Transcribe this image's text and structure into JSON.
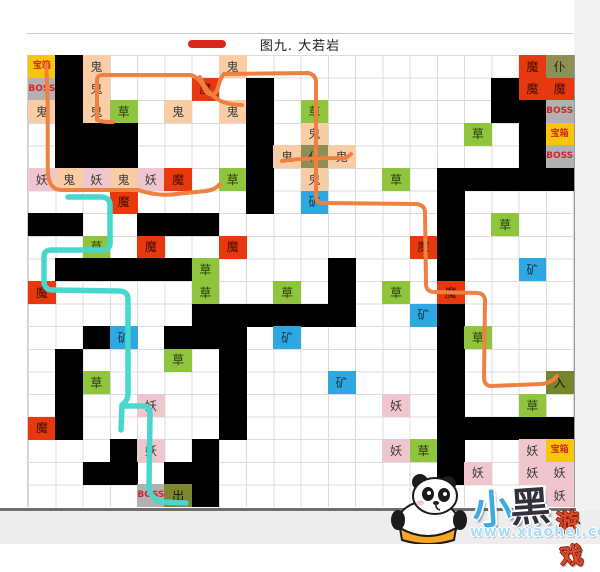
{
  "title": {
    "text": "图九. 大若岩",
    "dash_color": "#d8281e"
  },
  "watermark": {
    "part1": "小",
    "part2": "黑",
    "part3": "游戏",
    "url": "www.xiaohei.com"
  },
  "kinds": {
    "wall": {
      "bg": "#000000",
      "tx": "#000000",
      "label": ""
    },
    "ghost": {
      "bg": "#f8cda6",
      "tx": "#3a3a3a",
      "label": "鬼"
    },
    "demon": {
      "bg": "#f0c6ce",
      "tx": "#3a3a3a",
      "label": "妖"
    },
    "devil": {
      "bg": "#e8380d",
      "tx": "#431004",
      "label": "魔"
    },
    "grass": {
      "bg": "#8fc43d",
      "tx": "#2c3a10",
      "label": "草"
    },
    "ore": {
      "bg": "#2fa8e1",
      "tx": "#113a52",
      "label": "矿"
    },
    "chest": {
      "bg": "#f6c50c",
      "tx": "#d03018",
      "label": "宝箱",
      "small": true
    },
    "boss": {
      "bg": "#b2b0b0",
      "tx": "#d0262a",
      "label": "BOSS",
      "small": true
    },
    "servant": {
      "bg": "#8e8e55",
      "tx": "#26260f",
      "label": "仆"
    },
    "entrance": {
      "bg": "#77862c",
      "tx": "#131a04",
      "label": "入"
    },
    "exit": {
      "bg": "#7d8732",
      "tx": "#131a04",
      "label": "出"
    }
  },
  "grid": {
    "cols": 20,
    "rows": 20,
    "cell_w": 27.25,
    "cell_h": 22.6,
    "cells": [
      {
        "r": 1,
        "c": 1,
        "k": "chest"
      },
      {
        "r": 1,
        "c": 2,
        "k": "wall"
      },
      {
        "r": 1,
        "c": 3,
        "k": "ghost"
      },
      {
        "r": 1,
        "c": 8,
        "k": "ghost"
      },
      {
        "r": 1,
        "c": 19,
        "k": "devil"
      },
      {
        "r": 1,
        "c": 20,
        "k": "servant"
      },
      {
        "r": 2,
        "c": 1,
        "k": "boss"
      },
      {
        "r": 2,
        "c": 2,
        "k": "wall"
      },
      {
        "r": 2,
        "c": 3,
        "k": "ghost"
      },
      {
        "r": 2,
        "c": 7,
        "k": "devil"
      },
      {
        "r": 2,
        "c": 9,
        "k": "wall"
      },
      {
        "r": 2,
        "c": 18,
        "k": "wall"
      },
      {
        "r": 2,
        "c": 19,
        "k": "devil"
      },
      {
        "r": 2,
        "c": 20,
        "k": "devil"
      },
      {
        "r": 3,
        "c": 1,
        "k": "ghost"
      },
      {
        "r": 3,
        "c": 2,
        "k": "wall"
      },
      {
        "r": 3,
        "c": 3,
        "k": "ghost"
      },
      {
        "r": 3,
        "c": 4,
        "k": "grass"
      },
      {
        "r": 3,
        "c": 6,
        "k": "ghost"
      },
      {
        "r": 3,
        "c": 8,
        "k": "ghost"
      },
      {
        "r": 3,
        "c": 9,
        "k": "wall"
      },
      {
        "r": 3,
        "c": 11,
        "k": "grass"
      },
      {
        "r": 3,
        "c": 18,
        "k": "wall"
      },
      {
        "r": 3,
        "c": 19,
        "k": "wall"
      },
      {
        "r": 3,
        "c": 20,
        "k": "boss"
      },
      {
        "r": 4,
        "c": 2,
        "k": "wall"
      },
      {
        "r": 4,
        "c": 3,
        "k": "wall"
      },
      {
        "r": 4,
        "c": 4,
        "k": "wall"
      },
      {
        "r": 4,
        "c": 9,
        "k": "wall"
      },
      {
        "r": 4,
        "c": 11,
        "k": "ghost"
      },
      {
        "r": 4,
        "c": 17,
        "k": "grass"
      },
      {
        "r": 4,
        "c": 19,
        "k": "wall"
      },
      {
        "r": 4,
        "c": 20,
        "k": "chest"
      },
      {
        "r": 5,
        "c": 2,
        "k": "wall"
      },
      {
        "r": 5,
        "c": 3,
        "k": "wall"
      },
      {
        "r": 5,
        "c": 4,
        "k": "wall"
      },
      {
        "r": 5,
        "c": 9,
        "k": "wall"
      },
      {
        "r": 5,
        "c": 10,
        "k": "ghost"
      },
      {
        "r": 5,
        "c": 11,
        "k": "servant"
      },
      {
        "r": 5,
        "c": 12,
        "k": "ghost"
      },
      {
        "r": 5,
        "c": 19,
        "k": "wall"
      },
      {
        "r": 5,
        "c": 20,
        "k": "boss"
      },
      {
        "r": 6,
        "c": 1,
        "k": "demon"
      },
      {
        "r": 6,
        "c": 2,
        "k": "ghost"
      },
      {
        "r": 6,
        "c": 3,
        "k": "demon"
      },
      {
        "r": 6,
        "c": 4,
        "k": "ghost"
      },
      {
        "r": 6,
        "c": 5,
        "k": "demon"
      },
      {
        "r": 6,
        "c": 6,
        "k": "devil"
      },
      {
        "r": 6,
        "c": 8,
        "k": "grass"
      },
      {
        "r": 6,
        "c": 9,
        "k": "wall"
      },
      {
        "r": 6,
        "c": 11,
        "k": "ghost"
      },
      {
        "r": 6,
        "c": 14,
        "k": "grass"
      },
      {
        "r": 6,
        "c": 16,
        "k": "wall"
      },
      {
        "r": 6,
        "c": 17,
        "k": "wall"
      },
      {
        "r": 6,
        "c": 18,
        "k": "wall"
      },
      {
        "r": 6,
        "c": 19,
        "k": "wall"
      },
      {
        "r": 6,
        "c": 20,
        "k": "wall"
      },
      {
        "r": 7,
        "c": 4,
        "k": "devil"
      },
      {
        "r": 7,
        "c": 9,
        "k": "wall"
      },
      {
        "r": 7,
        "c": 11,
        "k": "ore"
      },
      {
        "r": 7,
        "c": 16,
        "k": "wall"
      },
      {
        "r": 8,
        "c": 1,
        "k": "wall"
      },
      {
        "r": 8,
        "c": 2,
        "k": "wall"
      },
      {
        "r": 8,
        "c": 5,
        "k": "wall"
      },
      {
        "r": 8,
        "c": 6,
        "k": "wall"
      },
      {
        "r": 8,
        "c": 7,
        "k": "wall"
      },
      {
        "r": 8,
        "c": 16,
        "k": "wall"
      },
      {
        "r": 8,
        "c": 18,
        "k": "grass"
      },
      {
        "r": 9,
        "c": 3,
        "k": "grass"
      },
      {
        "r": 9,
        "c": 5,
        "k": "devil"
      },
      {
        "r": 9,
        "c": 8,
        "k": "devil"
      },
      {
        "r": 9,
        "c": 15,
        "k": "devil"
      },
      {
        "r": 9,
        "c": 16,
        "k": "wall"
      },
      {
        "r": 10,
        "c": 2,
        "k": "wall"
      },
      {
        "r": 10,
        "c": 3,
        "k": "wall"
      },
      {
        "r": 10,
        "c": 4,
        "k": "wall"
      },
      {
        "r": 10,
        "c": 5,
        "k": "wall"
      },
      {
        "r": 10,
        "c": 6,
        "k": "wall"
      },
      {
        "r": 10,
        "c": 7,
        "k": "grass"
      },
      {
        "r": 10,
        "c": 12,
        "k": "wall"
      },
      {
        "r": 10,
        "c": 16,
        "k": "wall"
      },
      {
        "r": 10,
        "c": 19,
        "k": "ore"
      },
      {
        "r": 11,
        "c": 1,
        "k": "devil"
      },
      {
        "r": 11,
        "c": 7,
        "k": "grass"
      },
      {
        "r": 11,
        "c": 10,
        "k": "grass"
      },
      {
        "r": 11,
        "c": 12,
        "k": "wall"
      },
      {
        "r": 11,
        "c": 14,
        "k": "grass"
      },
      {
        "r": 11,
        "c": 16,
        "k": "devil"
      },
      {
        "r": 12,
        "c": 7,
        "k": "wall"
      },
      {
        "r": 12,
        "c": 8,
        "k": "wall"
      },
      {
        "r": 12,
        "c": 9,
        "k": "wall"
      },
      {
        "r": 12,
        "c": 10,
        "k": "wall"
      },
      {
        "r": 12,
        "c": 11,
        "k": "wall"
      },
      {
        "r": 12,
        "c": 12,
        "k": "wall"
      },
      {
        "r": 12,
        "c": 15,
        "k": "ore"
      },
      {
        "r": 12,
        "c": 16,
        "k": "wall"
      },
      {
        "r": 13,
        "c": 3,
        "k": "wall"
      },
      {
        "r": 13,
        "c": 4,
        "k": "ore"
      },
      {
        "r": 13,
        "c": 6,
        "k": "wall"
      },
      {
        "r": 13,
        "c": 7,
        "k": "wall"
      },
      {
        "r": 13,
        "c": 8,
        "k": "wall"
      },
      {
        "r": 13,
        "c": 10,
        "k": "ore"
      },
      {
        "r": 13,
        "c": 16,
        "k": "wall"
      },
      {
        "r": 13,
        "c": 17,
        "k": "grass"
      },
      {
        "r": 14,
        "c": 2,
        "k": "wall"
      },
      {
        "r": 14,
        "c": 6,
        "k": "grass"
      },
      {
        "r": 14,
        "c": 8,
        "k": "wall"
      },
      {
        "r": 14,
        "c": 16,
        "k": "wall"
      },
      {
        "r": 15,
        "c": 2,
        "k": "wall"
      },
      {
        "r": 15,
        "c": 3,
        "k": "grass"
      },
      {
        "r": 15,
        "c": 8,
        "k": "wall"
      },
      {
        "r": 15,
        "c": 12,
        "k": "ore"
      },
      {
        "r": 15,
        "c": 16,
        "k": "wall"
      },
      {
        "r": 15,
        "c": 20,
        "k": "entrance"
      },
      {
        "r": 16,
        "c": 2,
        "k": "wall"
      },
      {
        "r": 16,
        "c": 5,
        "k": "demon"
      },
      {
        "r": 16,
        "c": 8,
        "k": "wall"
      },
      {
        "r": 16,
        "c": 14,
        "k": "demon"
      },
      {
        "r": 16,
        "c": 16,
        "k": "wall"
      },
      {
        "r": 16,
        "c": 19,
        "k": "grass"
      },
      {
        "r": 17,
        "c": 1,
        "k": "devil"
      },
      {
        "r": 17,
        "c": 2,
        "k": "wall"
      },
      {
        "r": 17,
        "c": 8,
        "k": "wall"
      },
      {
        "r": 17,
        "c": 16,
        "k": "wall"
      },
      {
        "r": 17,
        "c": 17,
        "k": "wall"
      },
      {
        "r": 17,
        "c": 18,
        "k": "wall"
      },
      {
        "r": 17,
        "c": 19,
        "k": "wall"
      },
      {
        "r": 17,
        "c": 20,
        "k": "wall"
      },
      {
        "r": 18,
        "c": 4,
        "k": "wall"
      },
      {
        "r": 18,
        "c": 5,
        "k": "demon"
      },
      {
        "r": 18,
        "c": 7,
        "k": "wall"
      },
      {
        "r": 18,
        "c": 14,
        "k": "demon"
      },
      {
        "r": 18,
        "c": 15,
        "k": "grass"
      },
      {
        "r": 18,
        "c": 16,
        "k": "wall"
      },
      {
        "r": 18,
        "c": 19,
        "k": "demon"
      },
      {
        "r": 18,
        "c": 20,
        "k": "chest"
      },
      {
        "r": 19,
        "c": 3,
        "k": "wall"
      },
      {
        "r": 19,
        "c": 4,
        "k": "wall"
      },
      {
        "r": 19,
        "c": 6,
        "k": "wall"
      },
      {
        "r": 19,
        "c": 7,
        "k": "wall"
      },
      {
        "r": 19,
        "c": 16,
        "k": "wall"
      },
      {
        "r": 19,
        "c": 17,
        "k": "demon"
      },
      {
        "r": 19,
        "c": 19,
        "k": "demon"
      },
      {
        "r": 19,
        "c": 20,
        "k": "demon"
      },
      {
        "r": 20,
        "c": 5,
        "k": "boss"
      },
      {
        "r": 20,
        "c": 6,
        "k": "exit"
      },
      {
        "r": 20,
        "c": 7,
        "k": "wall"
      },
      {
        "r": 20,
        "c": 20,
        "k": "demon"
      }
    ]
  },
  "paths": {
    "stroke_orange": "#ef8040",
    "stroke_cyan": "#48d7cd",
    "orange": [
      "M 46 65 C 49 95 47 150 48 174 C 49 184 53 190 62 190 L 138 190 C 150 194 162 196 176 194 L 206 191 C 213 190 217 188 220 184",
      "M 97 120 L 97 80 C 97 76 99 75 104 75 L 190 75 C 196 76 201 81 204 88 C 207 94 211 96 215 93 C 219 90 218 80 224 74 L 308 73 C 313 74 316 77 316 82 L 316 196 C 316 201 318 203 323 203 L 415 204 C 421 204 425 207 425 212 L 426 284 C 426 289 429 292 434 292 L 477 293 C 482 293 485 296 485 301 L 484 377 C 484 382 486 386 491 386 L 542 384 C 549 383 554 380 557 376",
      "M 97 120 C 102 122 107 122 113 122",
      "M 200 77 C 205 89 213 98 223 102 C 229 104 235 105 242 105",
      "M 282 161 C 300 158 328 158 346 158 L 351 154"
    ],
    "cyan": [
      "M 68 197 L 101 197 C 107 197 110 200 110 205 L 110 243 C 110 248 107 250 102 250 L 52 250 C 46 250 44 252 44 257 L 44 281 C 44 287 47 290 53 290 L 119 291 C 125 291 128 294 128 299 L 128 394 C 128 399 126 402 122 405 L 121 430",
      "M 123 406 L 142 406 C 148 406 150 409 150 414 L 149 485 C 149 494 154 500 162 502 L 186 503"
    ]
  }
}
